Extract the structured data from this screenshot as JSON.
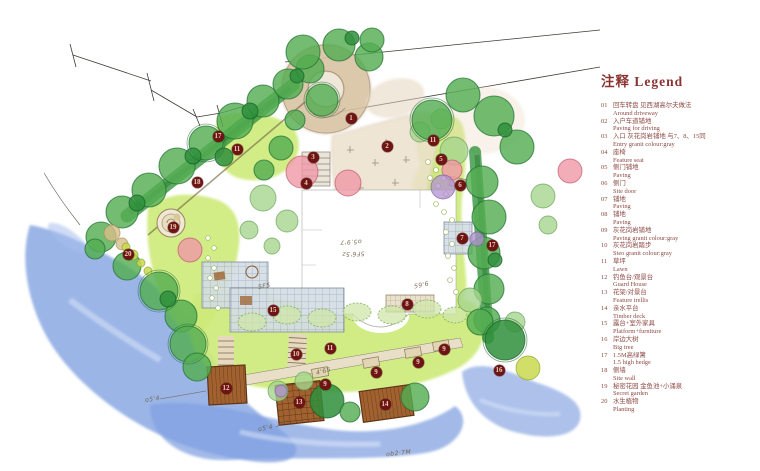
{
  "legend": {
    "title": "注释 Legend",
    "items": [
      {
        "num": "01",
        "zh": "回车转盘 见西湖高尔夫做法",
        "en": "Around driveway"
      },
      {
        "num": "02",
        "zh": "入户车道铺地",
        "en": "Paving for driving"
      },
      {
        "num": "03",
        "zh": "入口 灰花岗岩铺地 与7、8、15同",
        "en": "Entry granit colour:gray"
      },
      {
        "num": "04",
        "zh": "座椅",
        "en": "Feature seat"
      },
      {
        "num": "05",
        "zh": "侧门铺地",
        "en": "Paving"
      },
      {
        "num": "06",
        "zh": "侧门",
        "en": "Site door"
      },
      {
        "num": "07",
        "zh": "铺地",
        "en": "Paving"
      },
      {
        "num": "08",
        "zh": "铺地",
        "en": "Paving"
      },
      {
        "num": "09",
        "zh": "灰花岗岩铺地",
        "en": "Paving granit colour:gray"
      },
      {
        "num": "10",
        "zh": "灰花岗岩踏步",
        "en": "Steo granit colour:gray"
      },
      {
        "num": "11",
        "zh": "草坪",
        "en": "Lawn"
      },
      {
        "num": "12",
        "zh": "钓鱼台/观景台",
        "en": "Guard House"
      },
      {
        "num": "13",
        "zh": "花架/对景台",
        "en": "Feature trellis"
      },
      {
        "num": "14",
        "zh": "亲水平台",
        "en": "Timber deck"
      },
      {
        "num": "15",
        "zh": "露台+室外家具",
        "en": "Platform+furniture"
      },
      {
        "num": "16",
        "zh": "岸边大树",
        "en": "Big tree"
      },
      {
        "num": "17",
        "zh": "1.5M高绿篱",
        "en": "1.5 high hedge"
      },
      {
        "num": "18",
        "zh": "侧墙",
        "en": "Site wall"
      },
      {
        "num": "19",
        "zh": "秘密花园 金鱼池+小涌泉",
        "en": "Secret garden"
      },
      {
        "num": "20",
        "zh": "水生植物",
        "en": "Planting"
      }
    ]
  },
  "plan": {
    "markers": [
      {
        "label": "1",
        "x": 351,
        "y": 118
      },
      {
        "label": "2",
        "x": 387,
        "y": 146
      },
      {
        "label": "3",
        "x": 313,
        "y": 157
      },
      {
        "label": "4",
        "x": 306,
        "y": 183
      },
      {
        "label": "5",
        "x": 441,
        "y": 159
      },
      {
        "label": "6",
        "x": 460,
        "y": 185
      },
      {
        "label": "7",
        "x": 462,
        "y": 238
      },
      {
        "label": "8",
        "x": 407,
        "y": 304
      },
      {
        "label": "9",
        "x": 325,
        "y": 384
      },
      {
        "label": "9",
        "x": 376,
        "y": 372
      },
      {
        "label": "9",
        "x": 418,
        "y": 362
      },
      {
        "label": "9",
        "x": 444,
        "y": 349
      },
      {
        "label": "10",
        "x": 296,
        "y": 354
      },
      {
        "label": "11",
        "x": 237,
        "y": 149
      },
      {
        "label": "11",
        "x": 433,
        "y": 140
      },
      {
        "label": "11",
        "x": 330,
        "y": 348
      },
      {
        "label": "12",
        "x": 226,
        "y": 388
      },
      {
        "label": "13",
        "x": 299,
        "y": 402
      },
      {
        "label": "14",
        "x": 385,
        "y": 404
      },
      {
        "label": "15",
        "x": 273,
        "y": 310
      },
      {
        "label": "16",
        "x": 499,
        "y": 370
      },
      {
        "label": "17",
        "x": 218,
        "y": 136
      },
      {
        "label": "17",
        "x": 492,
        "y": 245
      },
      {
        "label": "18",
        "x": 197,
        "y": 182
      },
      {
        "label": "19",
        "x": 173,
        "y": 227
      },
      {
        "label": "20",
        "x": 128,
        "y": 254
      }
    ],
    "annotations": [
      {
        "text": "5F5",
        "x": 258,
        "y": 283,
        "rot": -10
      },
      {
        "text": "59'6",
        "x": 414,
        "y": 282,
        "rot": -12
      },
      {
        "text": "o5.9'7",
        "x": 340,
        "y": 238,
        "rot": 178
      },
      {
        "text": "5F6'5z",
        "x": 342,
        "y": 250,
        "rot": 178
      },
      {
        "text": "4'65",
        "x": 316,
        "y": 368,
        "rot": -15
      },
      {
        "text": "o5'4",
        "x": 145,
        "y": 396,
        "rot": -8
      },
      {
        "text": "o5'4",
        "x": 258,
        "y": 425,
        "rot": -10
      },
      {
        "text": "ol'2",
        "x": 376,
        "y": 412,
        "rot": -12
      },
      {
        "text": "ob2·7M",
        "x": 386,
        "y": 450,
        "rot": -6
      }
    ],
    "colors": {
      "marker": "#6e1414",
      "legend_text": "#8d4a44",
      "lawn": "#cdea79",
      "tree_green": "#54ad52",
      "water_blue": "#7fa0e0",
      "driveway_tan": "#d8c2a2",
      "deck_brown": "#9a5b2e"
    }
  }
}
